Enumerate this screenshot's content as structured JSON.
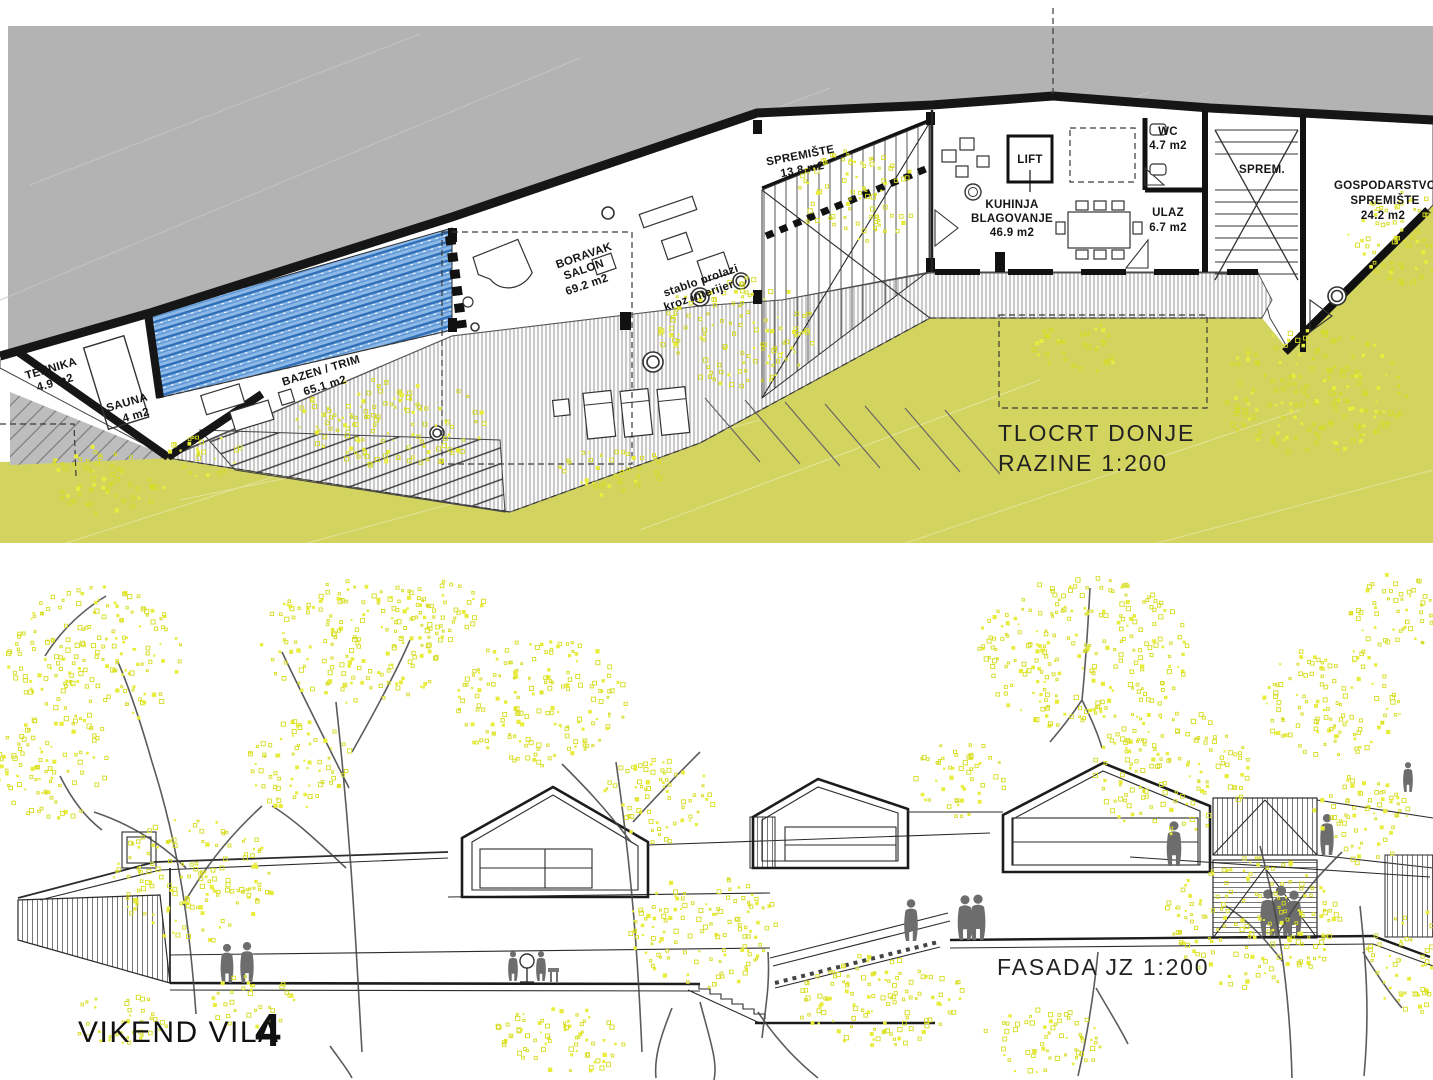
{
  "plan": {
    "title_line1": "TLOCRT DONJE",
    "title_line2": "RAZINE 1:200",
    "rooms": {
      "tehnika": {
        "name": "TEHNIKA",
        "area": "4.9 m2"
      },
      "sauna": {
        "name": "SAUNA",
        "area": "8.4 m2"
      },
      "bazen": {
        "name": "BAZEN / TRIM",
        "area": "65.1 m2"
      },
      "boravak": {
        "name": "BORAVAK",
        "name2": "SALON",
        "area": "69.2 m2"
      },
      "spremiste": {
        "name": "SPREMIŠTE",
        "area": "13.8 m2"
      },
      "kuhinja": {
        "name": "KUHINJA",
        "name2": "BLAGOVANJE",
        "area": "46.9 m2"
      },
      "lift": {
        "name": "LIFT"
      },
      "wc": {
        "name": "WC",
        "area": "4.7 m2"
      },
      "ulaz": {
        "name": "ULAZ",
        "area": "6.7 m2"
      },
      "sprem": {
        "name": "SPREM."
      },
      "gospodarstvo": {
        "name": "GOSPODARSTVO",
        "name2": "SPREMIŠTE",
        "area": "24.2 m2"
      }
    },
    "annotation": {
      "line1": "stablo prolazi",
      "line2": "kroz interijer"
    }
  },
  "facade": {
    "title": "FASADA JZ 1:200"
  },
  "footer": {
    "title": "VIKEND VILA",
    "number": "4"
  },
  "colors": {
    "hill_gray": "#b3b3b3",
    "grass": "#d3d35f",
    "foliage": "#e3e637",
    "pool_blue": "#85b4e6",
    "wall_black": "#161616"
  }
}
